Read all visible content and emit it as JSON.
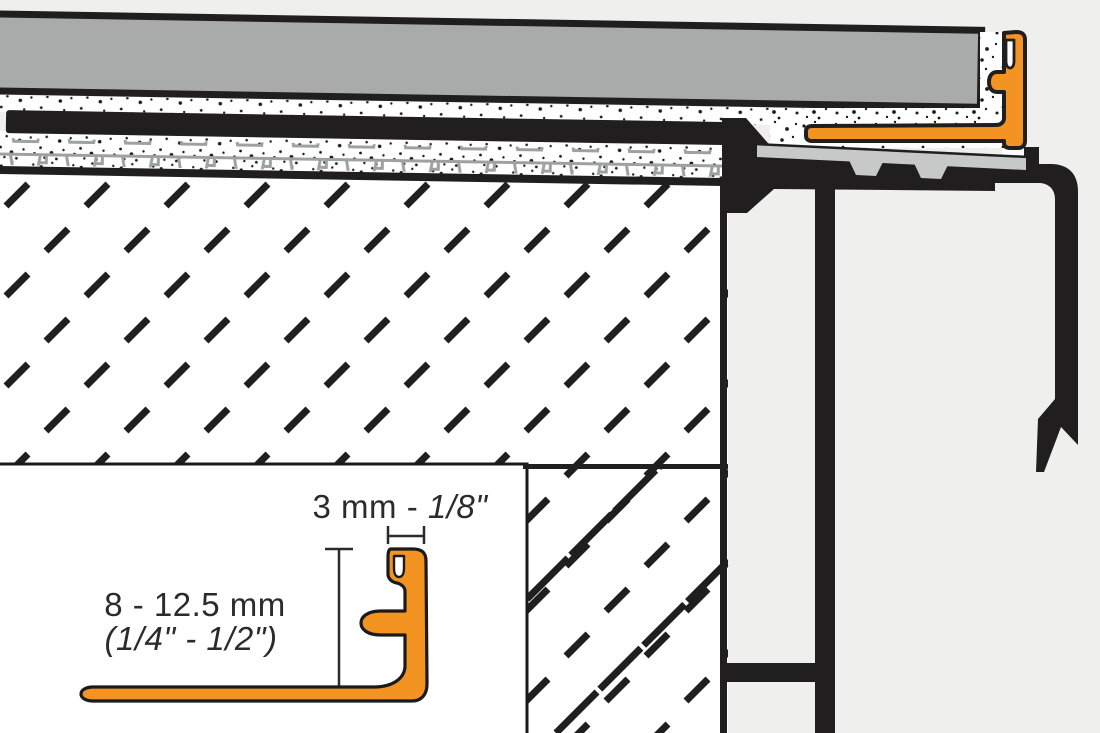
{
  "inset_detail": {
    "width_dimension": {
      "metric": "3 mm - ",
      "imperial": "1/8\""
    },
    "height_dimension": {
      "metric": "8 - 12.5 mm",
      "imperial": "(1/4\" - 1/2\")"
    }
  },
  "colors": {
    "profile_orange": "#F39422",
    "tile_gray": "#A9ABAA",
    "support_plate_gray": "#C7C9C8",
    "uncoupling_membrane_gray": "#9FA1A0",
    "line_black": "#201E1E",
    "paper_white": "#FFFFFF",
    "background": "#EFF0EE"
  }
}
